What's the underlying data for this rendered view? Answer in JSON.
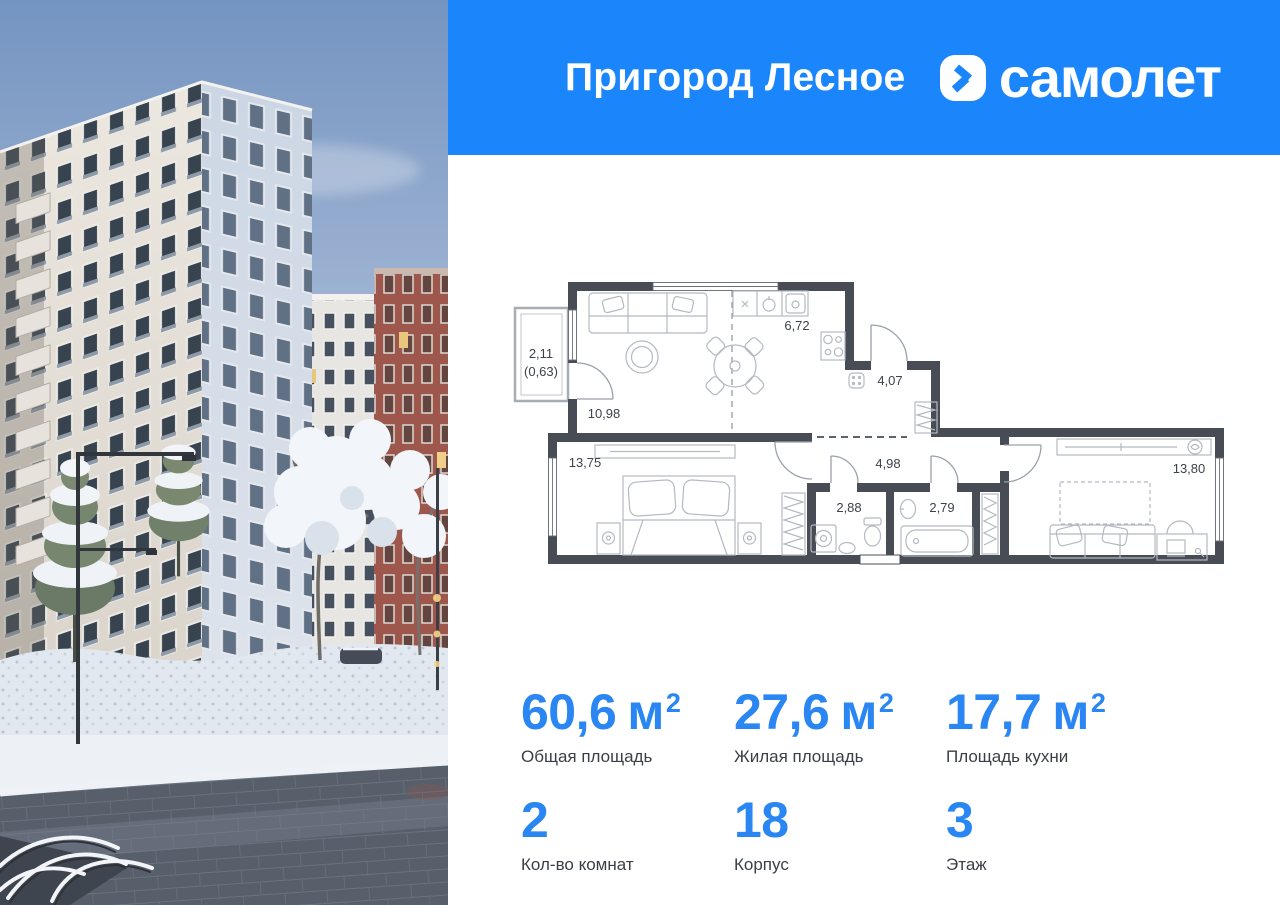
{
  "header": {
    "project_name": "Пригород Лесное",
    "brand_name": "самолет"
  },
  "floor_plan": {
    "balcony_area": "2,11",
    "balcony_area_reduced": "(0,63)",
    "living_room_area": "10,98",
    "kitchen_area": "6,72",
    "hallway_area": "4,07",
    "corridor_area": "4,98",
    "wc_area": "2,88",
    "bathroom_area": "2,79",
    "bedroom1_area": "13,75",
    "bedroom2_area": "13,80"
  },
  "stats": {
    "cells": [
      {
        "value": "60,6",
        "unit": "м",
        "unit_sup": "2",
        "label": "Общая площадь"
      },
      {
        "value": "27,6",
        "unit": "м",
        "unit_sup": "2",
        "label": "Жилая площадь"
      },
      {
        "value": "17,7",
        "unit": "м",
        "unit_sup": "2",
        "label": "Площадь кухни"
      },
      {
        "value": "2",
        "unit": "",
        "unit_sup": "",
        "label": "Кол-во комнат"
      },
      {
        "value": "18",
        "unit": "",
        "unit_sup": "",
        "label": "Корпус"
      },
      {
        "value": "3",
        "unit": "",
        "unit_sup": "",
        "label": "Этаж"
      }
    ]
  },
  "colors": {
    "brand_blue": "#1b86fb",
    "stat_value_blue": "#2a86f2",
    "plan_wall": "#474c55"
  }
}
